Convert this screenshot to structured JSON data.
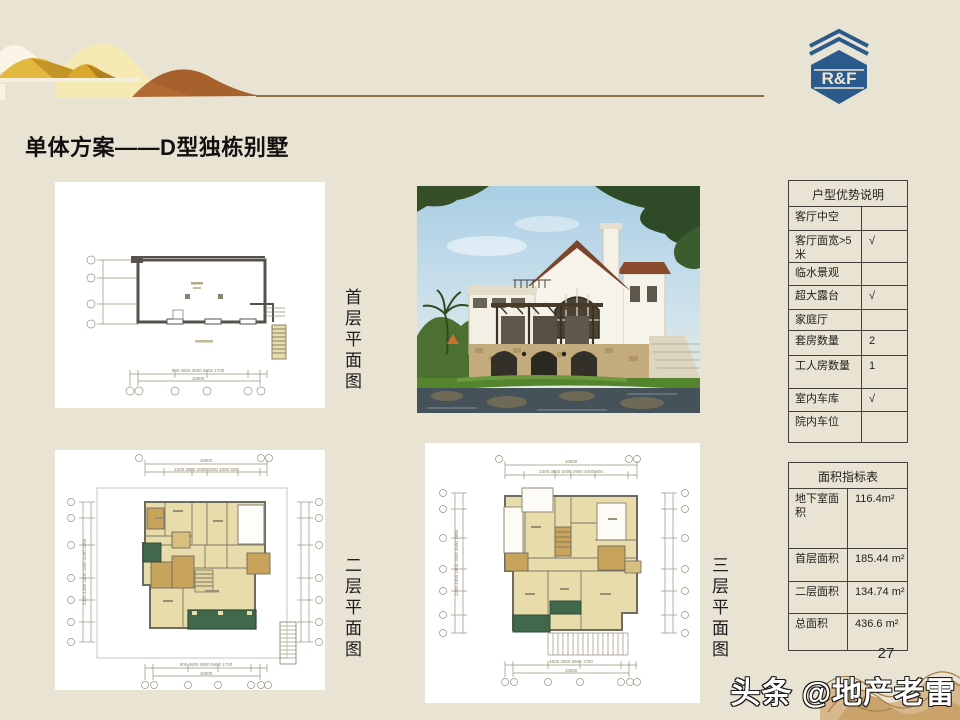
{
  "slide": {
    "title": "单体方案——D型独栋别墅",
    "page_number": "27",
    "watermark": "头条 @地产老雷",
    "logo_text": "R&F"
  },
  "plan_labels": {
    "first": "首层平面图",
    "second": "二层平面图",
    "third": "三层平面图"
  },
  "plans": {
    "first": {
      "total_width": "15800",
      "bottom_dims": "900  4600   3600   5800   1700"
    },
    "second": {
      "total_width": "15800",
      "top_dims": "2300  3800  2000  2900  4000  800",
      "bottom_dims": "900  4600  3600  5800  1700",
      "side_dims": "2300  4400  1800 1800  3500  1800"
    },
    "third": {
      "total_width": "15800",
      "top_dims": "2300  3800  2000  2900  4000  800",
      "bottom_dims": "4600   3600   5600   1700",
      "side_dims": "2300  4400  1800 1800  3500  1800"
    }
  },
  "advantage_table": {
    "title": "户型优势说明",
    "rows": [
      {
        "label": "客厅中空",
        "value": ""
      },
      {
        "label": "客厅面宽>5米",
        "value": "√"
      },
      {
        "label": "临水景观",
        "value": ""
      },
      {
        "label": "超大露台",
        "value": "√"
      },
      {
        "label": "家庭厅",
        "value": ""
      },
      {
        "label": "套房数量",
        "value": "2"
      },
      {
        "label": "工人房数量",
        "value": "1"
      },
      {
        "label": "室内车库",
        "value": "√"
      },
      {
        "label": "院内车位",
        "value": ""
      }
    ]
  },
  "area_table": {
    "title": "面积指标表",
    "rows": [
      {
        "label": "地下室面积",
        "value": "116.4m²"
      },
      {
        "label": "首层面积",
        "value": "185.44 m²"
      },
      {
        "label": "二层面积",
        "value": "134.74 m²"
      },
      {
        "label": "总面积",
        "value": "436.6 m²"
      }
    ]
  },
  "colors": {
    "slide-bg": "#e8e3d3",
    "accent-line": "#8a6f45",
    "logo-blue": "#2b5a8c",
    "hill-gold": "#ddb23c",
    "hill-brown": "#b16a33",
    "plan-room": "#e9dcab",
    "plan-khaki": "#c8a35c",
    "plan-green": "#41684d",
    "table-border": "#44423a",
    "title-color": "#111111"
  }
}
